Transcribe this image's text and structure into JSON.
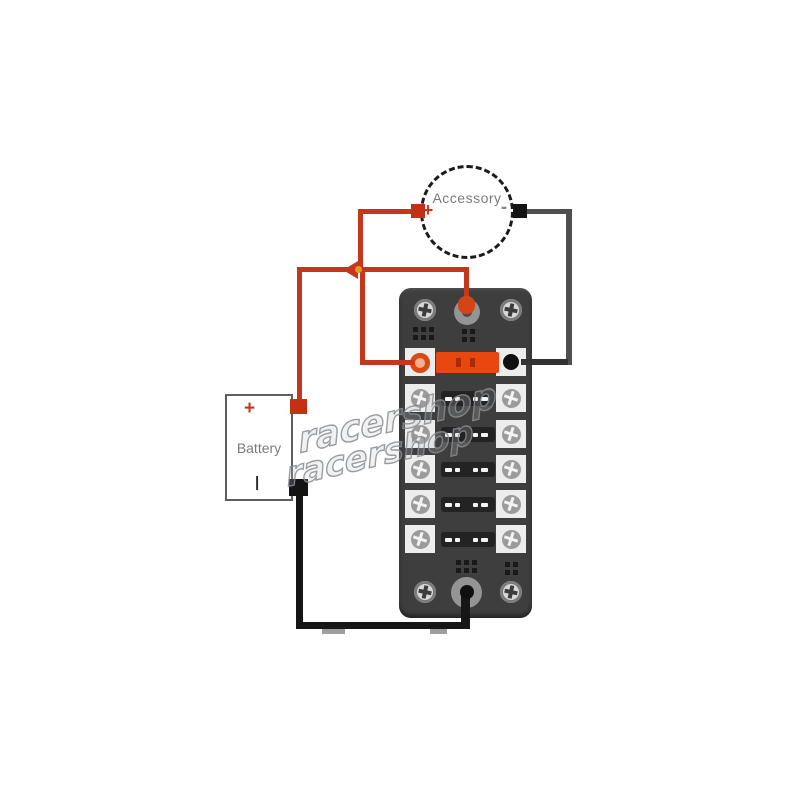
{
  "accessory": {
    "label": "Accessory",
    "plus_symbol": "+",
    "minus_symbol": "-"
  },
  "battery": {
    "label": "Battery",
    "plus_symbol": "+",
    "minus_symbol": "|"
  },
  "fuse_block": {
    "rows": 6,
    "installed_fuse_row": 1,
    "row_contact_dashes": 4,
    "corner_screws": 4,
    "bus_terminals": [
      "positive-top",
      "negative-bottom"
    ]
  },
  "watermark": {
    "line1": "racershop",
    "line2": "racershop"
  },
  "colors": {
    "positive_wire": "#c5371c",
    "negative_wire": "#161616",
    "accessory_negative_wire": "#4f4f4f",
    "fuse": "#e8480f",
    "block_body": "#3e3e3e",
    "terminal_white": "#ededed",
    "label_gray": "#7b7b7b"
  }
}
